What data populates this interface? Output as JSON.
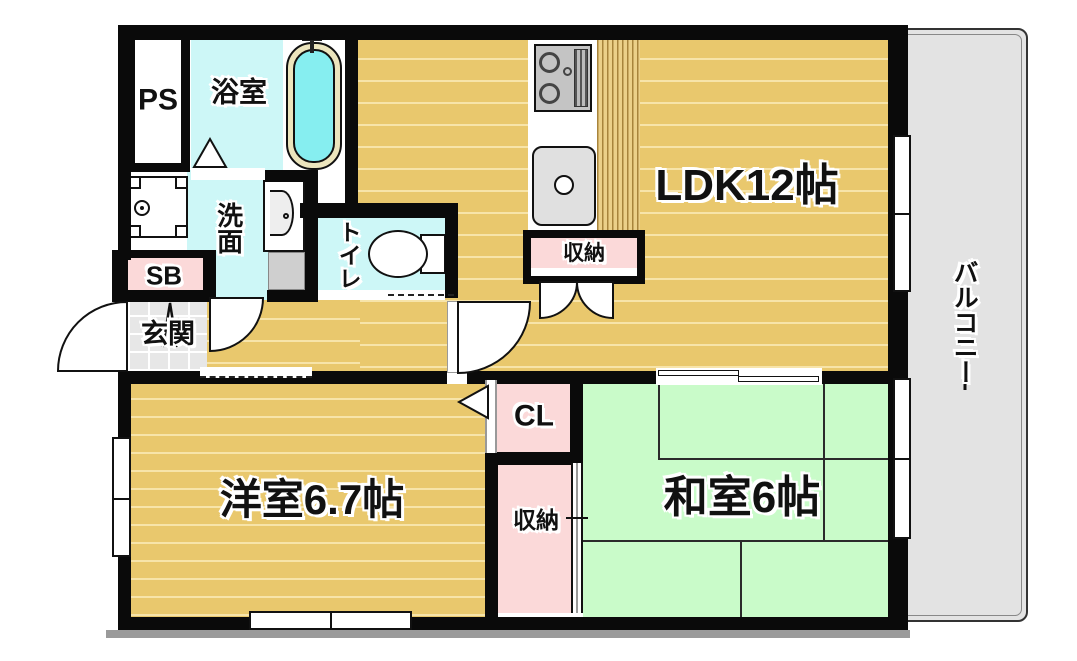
{
  "plan": {
    "title": "apartment-floor-plan",
    "rooms": {
      "ps": {
        "label": "PS"
      },
      "bathroom": {
        "label": "浴室"
      },
      "washroom": {
        "label": "洗面"
      },
      "toilet": {
        "label": "トイレ"
      },
      "shoe_box": {
        "label": "SB"
      },
      "entrance": {
        "label": "玄関"
      },
      "kitchen_storage": {
        "label": "収納"
      },
      "ldk": {
        "label": "LDK12帖"
      },
      "balcony": {
        "label": "バルコニー"
      },
      "closet": {
        "label": "CL"
      },
      "bedroom_storage": {
        "label": "収納"
      },
      "western_room": {
        "label": "洋室6.7帖"
      },
      "japanese_room": {
        "label": "和室6帖"
      }
    },
    "colors": {
      "wood_floor": "#e9c86d",
      "wood_stripe": "#f7e4a9",
      "tatami_green": "#c9fbc9",
      "closet_pink": "#fbd9d9",
      "water_cyan": "#cdf7f7",
      "tub_cyan": "#86eef0",
      "tub_rim": "#ece5bd",
      "balcony_gray": "#e3e3e3",
      "entrance_tile_gray": "#e7e7e7",
      "wall_black": "#0a0a0a"
    },
    "fixtures": [
      "bathtub",
      "washer-pan",
      "vanity-sink",
      "toilet-bowl",
      "gas-stove",
      "kitchen-sink"
    ]
  }
}
